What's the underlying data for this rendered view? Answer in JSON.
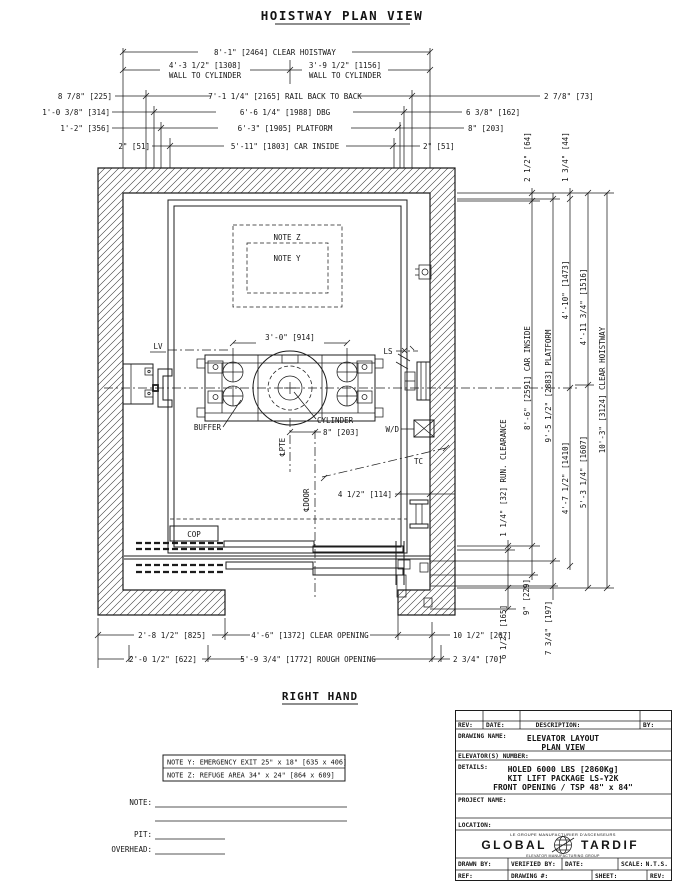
{
  "page": {
    "title": "HOISTWAY PLAN VIEW",
    "hand_label": "RIGHT HAND"
  },
  "dims_top": {
    "clear_hoistway": "8'-1\" [2464] CLEAR HOISTWAY",
    "wall_to_cyl_left": "4'-3 1/2\" [1308]",
    "wall_to_cyl_sub_left": "WALL TO CYLINDER",
    "wall_to_cyl_right": "3'-9 1/2\" [1156]",
    "wall_to_cyl_sub_right": "WALL TO CYLINDER",
    "rail_left": "8 7/8\" [225]",
    "rail": "7'-1 1/4\" [2165] RAIL BACK TO BACK",
    "rail_right": "2 7/8\" [73]",
    "dbg_left": "1'-0 3/8\" [314]",
    "dbg": "6'-6 1/4\" [1988] DBG",
    "dbg_right": "6 3/8\" [162]",
    "platform_left": "1'-2\" [356]",
    "platform": "6'-3\" [1905] PLATFORM",
    "platform_right": "8\" [203]",
    "car_left": "2\" [51]",
    "car": "5'-11\" [1803] CAR INSIDE",
    "car_right": "2\" [51]"
  },
  "dims_right": {
    "offset_car_top": "2 1/2\" [64]",
    "offset_platform_top": "1 3/4\" [44]",
    "car_inside": "8'-6\" [2591] CAR INSIDE",
    "platform": "9'-5 1/2\" [2883] PLATFORM",
    "rail_upper": "4'-10\" [1473]",
    "rail_lower": "4'-7 1/2\" [1410]",
    "cyl_upper": "4'-11 3/4\" [1516]",
    "cyl_lower": "5'-3 1/4\" [1607]",
    "clear_hoistway": "10'-3\" [3124] CLEAR HOISTWAY",
    "run_clearance": "1 1/4\" [32] RUN. CLEARANCE",
    "sill_a": "6 1/2\" [165]",
    "sill_b": "9\" [229]",
    "sill_c": "7 3/4\" [197]"
  },
  "dims_bottom": {
    "left_a": "2'-8 1/2\" [825]",
    "clear_opening": "4'-6\" [1372] CLEAR OPENING",
    "right_a": "10 1/2\" [267]",
    "left_b": "2'-0 1/2\" [622]",
    "rough_opening": "5'-9 3/4\" [1772] ROUGH OPENING",
    "right_b": "2 3/4\" [70]"
  },
  "plan": {
    "note_z_ref": "NOTE Z",
    "note_y_ref": "NOTE Y",
    "lv": "LV",
    "ls": "LS",
    "cyl_spacing": "3'-0\" [914]",
    "buffer": "BUFFER",
    "cylinder": "CYLINDER",
    "cyl_offset": "8\" [203]",
    "wd": "W/D",
    "tc": "TC",
    "door_offset": "4 1/2\" [114]",
    "cop": "COP",
    "cl_pte": "℄PTE",
    "cl_door": "℄DOOR"
  },
  "notes": {
    "note_y": "NOTE Y: EMERGENCY EXIT 25\" x 18\" [635 x 406]",
    "note_z": "NOTE Z: REFUGE AREA 34\" x 24\" [864 x 609]",
    "note_label": "NOTE:",
    "pit_label": "PIT:",
    "overhead_label": "OVERHEAD:"
  },
  "titleblock": {
    "rev": "REV:",
    "date": "DATE:",
    "description": "DESCRIPTION:",
    "by": "BY:",
    "drawing_name_label": "DRAWING NAME:",
    "drawing_name_1": "ELEVATOR LAYOUT",
    "drawing_name_2": "PLAN VIEW",
    "elevators_number_label": "ELEVATOR(S) NUMBER:",
    "details_label": "DETAILS:",
    "details_1": "HOLED 6000 LBS [2860Kg]",
    "details_2": "KIT LIFT PACKAGE LS-Y2K",
    "details_3": "FRONT OPENING / TSP 48\" x 84\"",
    "project_name_label": "PROJECT NAME:",
    "location_label": "LOCATION:",
    "logo_top": "LE GROUPE MANUFACTURIER D'ASCENSEURS",
    "logo_main_1": "GLOBAL",
    "logo_main_2": "TARDIF",
    "logo_bottom": "ELEVATOR MANUFACTURING GROUP",
    "drawn_by": "DRAWN BY:",
    "verified_by": "VERIFIED BY:",
    "date2": "DATE:",
    "scale_label": "SCALE:",
    "scale_value": "N.T.S.",
    "ref": "REF:",
    "drawing_no": "DRAWING #:",
    "sheet": "SHEET:",
    "rev2": "REV:"
  },
  "colors": {
    "line": "#1c1c1c",
    "bg": "#ffffff"
  }
}
